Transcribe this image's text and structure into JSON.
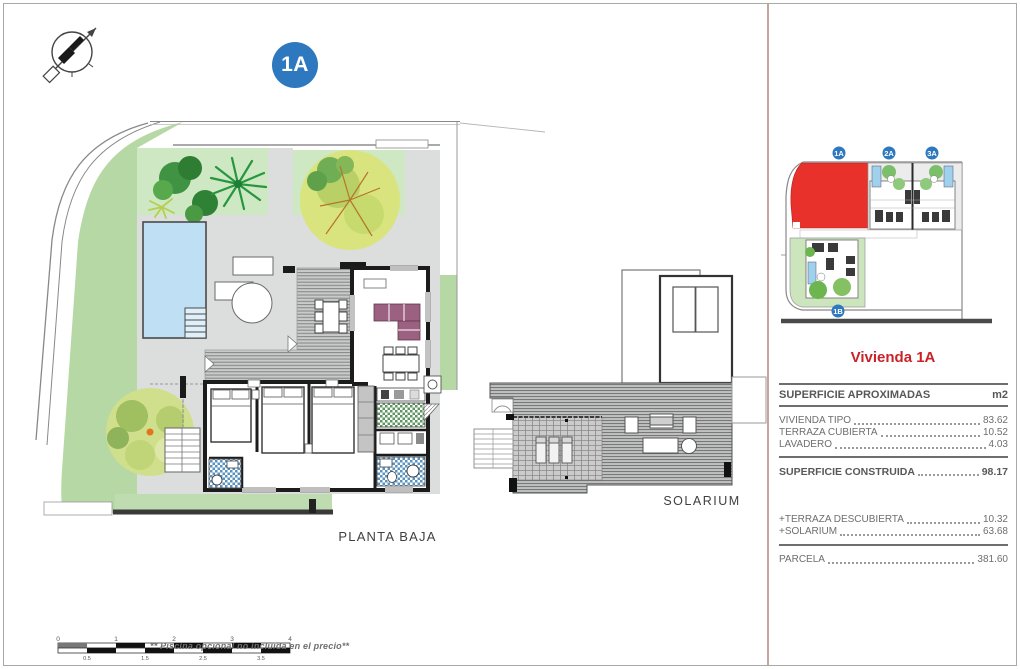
{
  "page": {
    "unit_badge": "1A",
    "plan_label": "PLANTA BAJA",
    "solarium_label": "SOLARIUM",
    "footnote": "** Piscina opcional no incluida en el precio**"
  },
  "site_map": {
    "badges": [
      "1A",
      "2A",
      "3A",
      "1B"
    ]
  },
  "panel": {
    "title": "Vivienda 1A",
    "table": {
      "header": {
        "label": "SUPERFICIE APROXIMADAS",
        "unit": "m2"
      },
      "rows": [
        {
          "label": "VIVIENDA TIPO",
          "value": "83.62"
        },
        {
          "label": "TERRAZA CUBIERTA",
          "value": "10.52"
        },
        {
          "label": "LAVADERO",
          "value": "4.03"
        }
      ],
      "total": {
        "label": "SUPERFICIE CONSTRUIDA",
        "value": "98.17"
      },
      "extras": [
        {
          "label": "+TERRAZA DESCUBIERTA",
          "value": "10.32"
        },
        {
          "label": "+SOLARIUM",
          "value": "63.68"
        }
      ],
      "parcel": {
        "label": "PARCELA",
        "value": "381.60"
      }
    }
  },
  "scale_bar": {
    "top_labels": [
      "0",
      "1",
      "2",
      "3",
      "4"
    ],
    "bottom_labels": [
      "0.5",
      "1.5",
      "2.5",
      "3.5"
    ]
  },
  "colors": {
    "highlight_red": "#e8312a",
    "badge_blue": "#2e78bf",
    "title_red": "#c9232a",
    "pool_blue": "#bfe0f4",
    "lawn_green": "#b6d8a5"
  }
}
